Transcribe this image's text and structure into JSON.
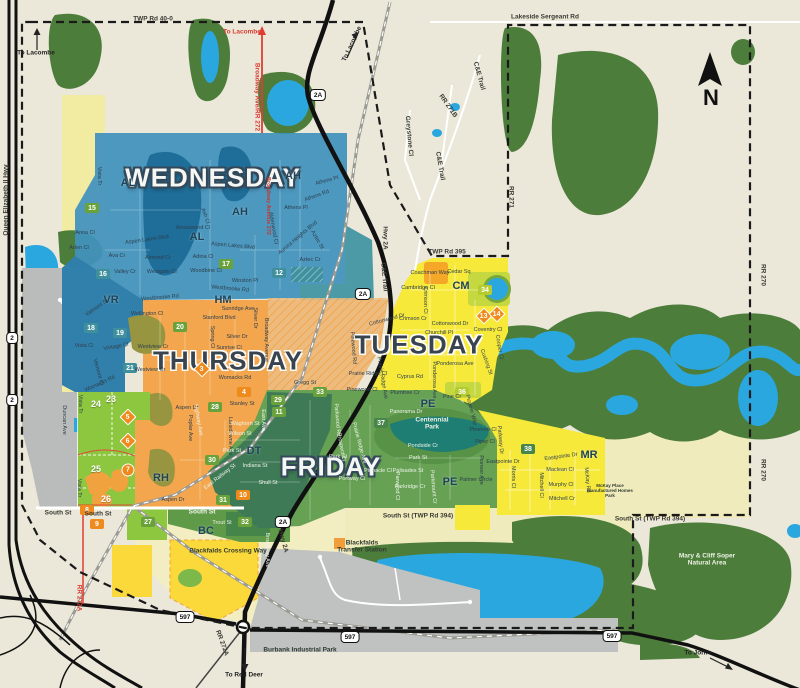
{
  "compass": {
    "label": "N"
  },
  "days": [
    {
      "t": "WEDNESDAY",
      "x": 213,
      "y": 178,
      "c": "light"
    },
    {
      "t": "THURSDAY",
      "x": 228,
      "y": 361,
      "c": "dark"
    },
    {
      "t": "TUESDAY",
      "x": 419,
      "y": 345,
      "c": "dark"
    },
    {
      "t": "FRIDAY",
      "x": 331,
      "y": 467,
      "c": "light"
    }
  ],
  "areas": [
    {
      "t": "AH",
      "x": 293,
      "y": 176
    },
    {
      "t": "AH",
      "x": 240,
      "y": 212
    },
    {
      "t": "AL",
      "x": 128,
      "y": 183
    },
    {
      "t": "AL",
      "x": 197,
      "y": 237
    },
    {
      "t": "VR",
      "x": 111,
      "y": 300
    },
    {
      "t": "HM",
      "x": 223,
      "y": 300
    },
    {
      "t": "CM",
      "x": 461,
      "y": 286
    },
    {
      "t": "PE",
      "x": 428,
      "y": 404
    },
    {
      "t": "PE",
      "x": 450,
      "y": 482
    },
    {
      "t": "DT",
      "x": 254,
      "y": 451
    },
    {
      "t": "RH",
      "x": 161,
      "y": 478
    },
    {
      "t": "BC",
      "x": 206,
      "y": 531
    },
    {
      "t": "MR",
      "x": 589,
      "y": 455
    }
  ],
  "zone_markers": [
    {
      "t": "15",
      "x": 92,
      "y": 208,
      "k": "g"
    },
    {
      "t": "16",
      "x": 103,
      "y": 274,
      "k": "t"
    },
    {
      "t": "17",
      "x": 226,
      "y": 264,
      "k": "g"
    },
    {
      "t": "12",
      "x": 279,
      "y": 273,
      "k": "t"
    },
    {
      "t": "18",
      "x": 91,
      "y": 328,
      "k": "t"
    },
    {
      "t": "19",
      "x": 120,
      "y": 333,
      "k": "t"
    },
    {
      "t": "20",
      "x": 180,
      "y": 327,
      "k": "g"
    },
    {
      "t": "21",
      "x": 130,
      "y": 368,
      "k": "t"
    },
    {
      "t": "24",
      "x": 96,
      "y": 404,
      "k": "w"
    },
    {
      "t": "23",
      "x": 111,
      "y": 399,
      "k": "w"
    },
    {
      "t": "25",
      "x": 96,
      "y": 469,
      "k": "w"
    },
    {
      "t": "26",
      "x": 106,
      "y": 499,
      "k": "w"
    },
    {
      "t": "8",
      "x": 87,
      "y": 510,
      "k": "o"
    },
    {
      "t": "9",
      "x": 97,
      "y": 524,
      "k": "o"
    },
    {
      "t": "27",
      "x": 148,
      "y": 522,
      "k": "g"
    },
    {
      "t": "7",
      "x": 128,
      "y": 470,
      "k": "oc"
    },
    {
      "t": "5",
      "x": 128,
      "y": 417,
      "k": "od"
    },
    {
      "t": "6",
      "x": 128,
      "y": 441,
      "k": "od"
    },
    {
      "t": "3",
      "x": 202,
      "y": 369,
      "k": "od"
    },
    {
      "t": "4",
      "x": 244,
      "y": 392,
      "k": "o"
    },
    {
      "t": "28",
      "x": 215,
      "y": 407,
      "k": "g"
    },
    {
      "t": "29",
      "x": 278,
      "y": 400,
      "k": "g"
    },
    {
      "t": "11",
      "x": 279,
      "y": 412,
      "k": "g"
    },
    {
      "t": "33",
      "x": 320,
      "y": 392,
      "k": "g"
    },
    {
      "t": "30",
      "x": 212,
      "y": 460,
      "k": "g"
    },
    {
      "t": "31",
      "x": 223,
      "y": 500,
      "k": "g"
    },
    {
      "t": "10",
      "x": 243,
      "y": 495,
      "k": "o"
    },
    {
      "t": "32",
      "x": 245,
      "y": 522,
      "k": "g"
    },
    {
      "t": "34",
      "x": 485,
      "y": 290,
      "k": "yg"
    },
    {
      "t": "36",
      "x": 462,
      "y": 392,
      "k": "yg"
    },
    {
      "t": "37",
      "x": 381,
      "y": 423,
      "k": "dg"
    },
    {
      "t": "38",
      "x": 528,
      "y": 449,
      "k": "dg"
    },
    {
      "t": "13",
      "x": 484,
      "y": 316,
      "k": "od"
    },
    {
      "t": "14",
      "x": 497,
      "y": 314,
      "k": "od"
    }
  ],
  "streets": [
    {
      "t": "Vista Tr",
      "x": 99,
      "y": 176,
      "r": 90
    },
    {
      "t": "Anna Cl",
      "x": 85,
      "y": 233
    },
    {
      "t": "Arlen Cl",
      "x": 79,
      "y": 248
    },
    {
      "t": "Ava Cr",
      "x": 117,
      "y": 256
    },
    {
      "t": "Valley Cr",
      "x": 125,
      "y": 272
    },
    {
      "t": "Aspen Lakes Blvd",
      "x": 147,
      "y": 240,
      "r": -8
    },
    {
      "t": "Aspen Lakes Blvd",
      "x": 233,
      "y": 246,
      "r": 5
    },
    {
      "t": "Almond Cr",
      "x": 158,
      "y": 258
    },
    {
      "t": "Westgate Cr",
      "x": 162,
      "y": 272
    },
    {
      "t": "Westbrooke Rd",
      "x": 160,
      "y": 298,
      "r": -5
    },
    {
      "t": "Westbrooke Rd",
      "x": 230,
      "y": 289,
      "r": 5
    },
    {
      "t": "Adina Cl",
      "x": 203,
      "y": 257
    },
    {
      "t": "Woodbine Cl",
      "x": 206,
      "y": 271
    },
    {
      "t": "Arrowwood Cl",
      "x": 193,
      "y": 228
    },
    {
      "t": "Ash Cl",
      "x": 205,
      "y": 216,
      "r": 70
    },
    {
      "t": "Winston Pl",
      "x": 245,
      "y": 281
    },
    {
      "t": "Athens Pl",
      "x": 327,
      "y": 181,
      "r": -15
    },
    {
      "t": "Athens Rd",
      "x": 317,
      "y": 196,
      "r": -20
    },
    {
      "t": "Athens Pl",
      "x": 296,
      "y": 208
    },
    {
      "t": "Aurora Heights Blvd",
      "x": 298,
      "y": 238,
      "r": -40
    },
    {
      "t": "Aztec St",
      "x": 317,
      "y": 240,
      "r": 60
    },
    {
      "t": "Aztec Cr",
      "x": 310,
      "y": 260
    },
    {
      "t": "Alderwood Cl",
      "x": 273,
      "y": 228,
      "r": 80
    },
    {
      "t": "Broadway Avenue 272",
      "x": 268,
      "y": 206,
      "r": 90,
      "c": "red"
    },
    {
      "t": "Valmont St",
      "x": 97,
      "y": 308,
      "r": -35
    },
    {
      "t": "Vista Cl",
      "x": 84,
      "y": 346
    },
    {
      "t": "Vintage Cl",
      "x": 116,
      "y": 347,
      "r": -10
    },
    {
      "t": "Vermont Cl",
      "x": 98,
      "y": 372,
      "r": 75
    },
    {
      "t": "Wellington Cl",
      "x": 147,
      "y": 314
    },
    {
      "t": "Sunridge Ave",
      "x": 238,
      "y": 309
    },
    {
      "t": "Stanford Blvd",
      "x": 219,
      "y": 318
    },
    {
      "t": "Silver Dr",
      "x": 237,
      "y": 337
    },
    {
      "t": "Silver Dr",
      "x": 255,
      "y": 318,
      "r": 90
    },
    {
      "t": "Sunrise Cl",
      "x": 229,
      "y": 348
    },
    {
      "t": "Spring Cl",
      "x": 212,
      "y": 337,
      "r": 90
    },
    {
      "t": "Westview Cr",
      "x": 153,
      "y": 347
    },
    {
      "t": "Westview Cr",
      "x": 150,
      "y": 370
    },
    {
      "t": "Womacks Rd",
      "x": 235,
      "y": 378
    },
    {
      "t": "Womacks Rd",
      "x": 100,
      "y": 384,
      "r": -25
    },
    {
      "t": "Gregg St",
      "x": 305,
      "y": 383
    },
    {
      "t": "Stanley St",
      "x": 242,
      "y": 404
    },
    {
      "t": "Aspen Dr",
      "x": 187,
      "y": 408
    },
    {
      "t": "Aspen Dr",
      "x": 173,
      "y": 500
    },
    {
      "t": "Poplar Ave",
      "x": 190,
      "y": 428,
      "r": 90
    },
    {
      "t": "Lansdowne Ave",
      "x": 230,
      "y": 436,
      "r": 90
    },
    {
      "t": "Broadway Avenue",
      "x": 266,
      "y": 340,
      "r": 90
    },
    {
      "t": "Duncan Ave",
      "x": 64,
      "y": 420,
      "r": 90
    },
    {
      "t": "Vista Tr",
      "x": 80,
      "y": 404,
      "r": 90
    },
    {
      "t": "Vista Tr",
      "x": 79,
      "y": 488,
      "r": 90
    },
    {
      "t": "Coachman Way",
      "x": 430,
      "y": 273
    },
    {
      "t": "Cedar Sq",
      "x": 459,
      "y": 272
    },
    {
      "t": "Cambridge Cl",
      "x": 418,
      "y": 288
    },
    {
      "t": "Crimson Cl",
      "x": 425,
      "y": 300,
      "r": 90
    },
    {
      "t": "Crimson Cr",
      "x": 413,
      "y": 319
    },
    {
      "t": "Cottonwood Dr",
      "x": 450,
      "y": 324
    },
    {
      "t": "Cottonwood Dr",
      "x": 387,
      "y": 320,
      "r": -15
    },
    {
      "t": "Churchill Pl",
      "x": 439,
      "y": 333
    },
    {
      "t": "Ponderosa Ave",
      "x": 455,
      "y": 364
    },
    {
      "t": "Ponderosa Ave",
      "x": 434,
      "y": 380,
      "r": 90
    },
    {
      "t": "Cyprus Rd",
      "x": 410,
      "y": 377
    },
    {
      "t": "Plumtree Cr",
      "x": 405,
      "y": 393
    },
    {
      "t": "Pine Cr",
      "x": 452,
      "y": 397
    },
    {
      "t": "Prairie Ridge Cl",
      "x": 368,
      "y": 374
    },
    {
      "t": "Prairie Ridge Ave",
      "x": 382,
      "y": 378,
      "r": 80
    },
    {
      "t": "Pinewood Cl",
      "x": 362,
      "y": 390
    },
    {
      "t": "Pinewood Rd",
      "x": 353,
      "y": 348,
      "r": 85
    },
    {
      "t": "Pioneer Way",
      "x": 471,
      "y": 410,
      "r": 75
    },
    {
      "t": "Coventry Cl",
      "x": 488,
      "y": 330
    },
    {
      "t": "Cooper Cl",
      "x": 499,
      "y": 347,
      "r": 80
    },
    {
      "t": "Cushing St",
      "x": 486,
      "y": 362,
      "r": 70
    },
    {
      "t": "Panorama Dr",
      "x": 406,
      "y": 412,
      "c": "l"
    },
    {
      "t": "Pondside Cr",
      "x": 423,
      "y": 446,
      "c": "l"
    },
    {
      "t": "Park St",
      "x": 418,
      "y": 458,
      "c": "l"
    },
    {
      "t": "Park St",
      "x": 338,
      "y": 457,
      "c": "l"
    },
    {
      "t": "Palisades St",
      "x": 408,
      "y": 471,
      "c": "l"
    },
    {
      "t": "Parkridge Cr",
      "x": 410,
      "y": 487,
      "c": "l"
    },
    {
      "t": "Pinnacle Cl",
      "x": 378,
      "y": 471,
      "c": "l"
    },
    {
      "t": "Portway Cl",
      "x": 352,
      "y": 479,
      "c": "l"
    },
    {
      "t": "Parkwood Rd",
      "x": 337,
      "y": 420,
      "r": 85,
      "c": "l"
    },
    {
      "t": "Prospect Cl",
      "x": 341,
      "y": 447,
      "r": 80,
      "c": "l"
    },
    {
      "t": "Prairie Ridge Ave",
      "x": 359,
      "y": 443,
      "r": 75,
      "c": "l"
    },
    {
      "t": "Parwood Cl",
      "x": 397,
      "y": 486,
      "r": 90,
      "c": "l"
    },
    {
      "t": "Parkmount Cr",
      "x": 433,
      "y": 487,
      "r": 85,
      "c": "l"
    },
    {
      "t": "Waghorn St",
      "x": 245,
      "y": 424,
      "c": "l"
    },
    {
      "t": "Wilson St",
      "x": 240,
      "y": 434,
      "c": "l"
    },
    {
      "t": "Park St",
      "x": 232,
      "y": 451,
      "c": "l"
    },
    {
      "t": "East Ave",
      "x": 263,
      "y": 420,
      "r": 90,
      "c": "l"
    },
    {
      "t": "Highway Ave",
      "x": 198,
      "y": 420,
      "r": 80,
      "c": "l"
    },
    {
      "t": "Indiana St",
      "x": 255,
      "y": 466,
      "c": "l"
    },
    {
      "t": "Shull St",
      "x": 268,
      "y": 483,
      "c": "l"
    },
    {
      "t": "East Railway St",
      "x": 220,
      "y": 477,
      "r": -38,
      "c": "l"
    },
    {
      "t": "Trout St",
      "x": 222,
      "y": 523,
      "c": "l"
    },
    {
      "t": "Broadway Ave",
      "x": 267,
      "y": 550,
      "r": 90,
      "c": "l"
    },
    {
      "t": "Pinetree Cl",
      "x": 483,
      "y": 430
    },
    {
      "t": "Piper Cl",
      "x": 485,
      "y": 442
    },
    {
      "t": "Parkway Dr",
      "x": 500,
      "y": 440,
      "r": 85
    },
    {
      "t": "Pioneer Ave",
      "x": 481,
      "y": 470,
      "r": 90
    },
    {
      "t": "Eastpointe Dr",
      "x": 503,
      "y": 462
    },
    {
      "t": "Eastpointe Dr",
      "x": 561,
      "y": 457,
      "r": -8
    },
    {
      "t": "Palmer Circle",
      "x": 476,
      "y": 480
    },
    {
      "t": "Morris Cl",
      "x": 513,
      "y": 477,
      "r": 90
    },
    {
      "t": "Maclean Cl",
      "x": 560,
      "y": 470
    },
    {
      "t": "Murphy Cl",
      "x": 561,
      "y": 485
    },
    {
      "t": "Mitchell Cr",
      "x": 562,
      "y": 499
    },
    {
      "t": "Mitchell Cl",
      "x": 541,
      "y": 485,
      "r": 90
    },
    {
      "t": "McKay Rd",
      "x": 587,
      "y": 480,
      "r": 85
    }
  ],
  "roads": [
    {
      "t": "TWP Rd 40-0",
      "x": 153,
      "y": 19
    },
    {
      "t": "Lakeside Sergeant Rd",
      "x": 545,
      "y": 17
    },
    {
      "t": "TWP Rd 395",
      "x": 447,
      "y": 252
    },
    {
      "t": "RR 271",
      "x": 511,
      "y": 197,
      "r": 90
    },
    {
      "t": "RR 270",
      "x": 763,
      "y": 275,
      "r": 90
    },
    {
      "t": "RR 270",
      "x": 763,
      "y": 470,
      "r": 90
    },
    {
      "t": "South St (TWP Rd 394)",
      "x": 418,
      "y": 516
    },
    {
      "t": "South St (TWP Rd 394)",
      "x": 650,
      "y": 519
    },
    {
      "t": "South St",
      "x": 58,
      "y": 513
    },
    {
      "t": "South St",
      "x": 98,
      "y": 514
    },
    {
      "t": "South St",
      "x": 202,
      "y": 512,
      "c": "lt"
    },
    {
      "t": "C&E Trail",
      "x": 479,
      "y": 76,
      "r": 75
    },
    {
      "t": "C&E Trail",
      "x": 440,
      "y": 166,
      "r": 80
    },
    {
      "t": "C&E Trail",
      "x": 384,
      "y": 277,
      "r": 85
    },
    {
      "t": "RR 271B",
      "x": 448,
      "y": 106,
      "r": 55
    },
    {
      "t": "Greystone Cl",
      "x": 409,
      "y": 136,
      "r": 85
    },
    {
      "t": "Hwy 2A",
      "x": 385,
      "y": 238,
      "r": 90
    },
    {
      "t": "Hwy 2A",
      "x": 283,
      "y": 541,
      "r": 75
    },
    {
      "t": "Queen Elizabeth II Hwy",
      "x": 6,
      "y": 200,
      "r": -90
    },
    {
      "t": "Broadway Ave/RR 272",
      "x": 257,
      "y": 97,
      "r": 90,
      "c": "red"
    },
    {
      "t": "RR 272A",
      "x": 222,
      "y": 643,
      "r": 70
    },
    {
      "t": "RR 272A",
      "x": 79,
      "y": 598,
      "r": 90,
      "c": "red"
    }
  ],
  "places": [
    {
      "t": "Centennial Park",
      "x": 432,
      "y": 424,
      "c": "lt",
      "w": 46
    },
    {
      "t": "Blackfalds Transfer Station",
      "x": 362,
      "y": 547,
      "w": 52
    },
    {
      "t": "Burbank Industrial Park",
      "x": 300,
      "y": 650
    },
    {
      "t": "Mary & Cliff Soper Natural Area",
      "x": 707,
      "y": 560,
      "c": "lt",
      "w": 72
    },
    {
      "t": "Blackfalds Crossing Way",
      "x": 228,
      "y": 551
    },
    {
      "t": "McKay Place Manufactured Homes Park",
      "x": 610,
      "y": 491,
      "c": "tiny",
      "w": 48
    }
  ],
  "directions": [
    {
      "t": "To Lacombe",
      "x": 36,
      "y": 53
    },
    {
      "t": "To Lacombe",
      "x": 242,
      "y": 32,
      "c": "red"
    },
    {
      "t": "To Lacombe",
      "x": 352,
      "y": 44,
      "r": -65
    },
    {
      "t": "To Red Deer",
      "x": 244,
      "y": 675
    },
    {
      "t": "To Joffre",
      "x": 698,
      "y": 653
    }
  ],
  "shields": [
    {
      "t": "2A",
      "x": 318,
      "y": 95
    },
    {
      "t": "2A",
      "x": 363,
      "y": 294
    },
    {
      "t": "2A",
      "x": 283,
      "y": 522
    },
    {
      "t": "2",
      "x": 12,
      "y": 338
    },
    {
      "t": "2",
      "x": 12,
      "y": 400
    },
    {
      "t": "597",
      "x": 185,
      "y": 617
    },
    {
      "t": "597",
      "x": 350,
      "y": 637
    },
    {
      "t": "597",
      "x": 612,
      "y": 636
    }
  ],
  "colors": {
    "wednesday_blue": "#4293bd",
    "thursday_orange": "#f3a64e",
    "tuesday_yellow": "#f7e93a",
    "friday_green": "#66a154",
    "lime_zone": "#8dc63f",
    "water_blue": "#2ba7e0",
    "forest_green": "#4d7d3b",
    "industrial_gray": "#b9bcba",
    "marker_orange": "#ef8a1c"
  }
}
